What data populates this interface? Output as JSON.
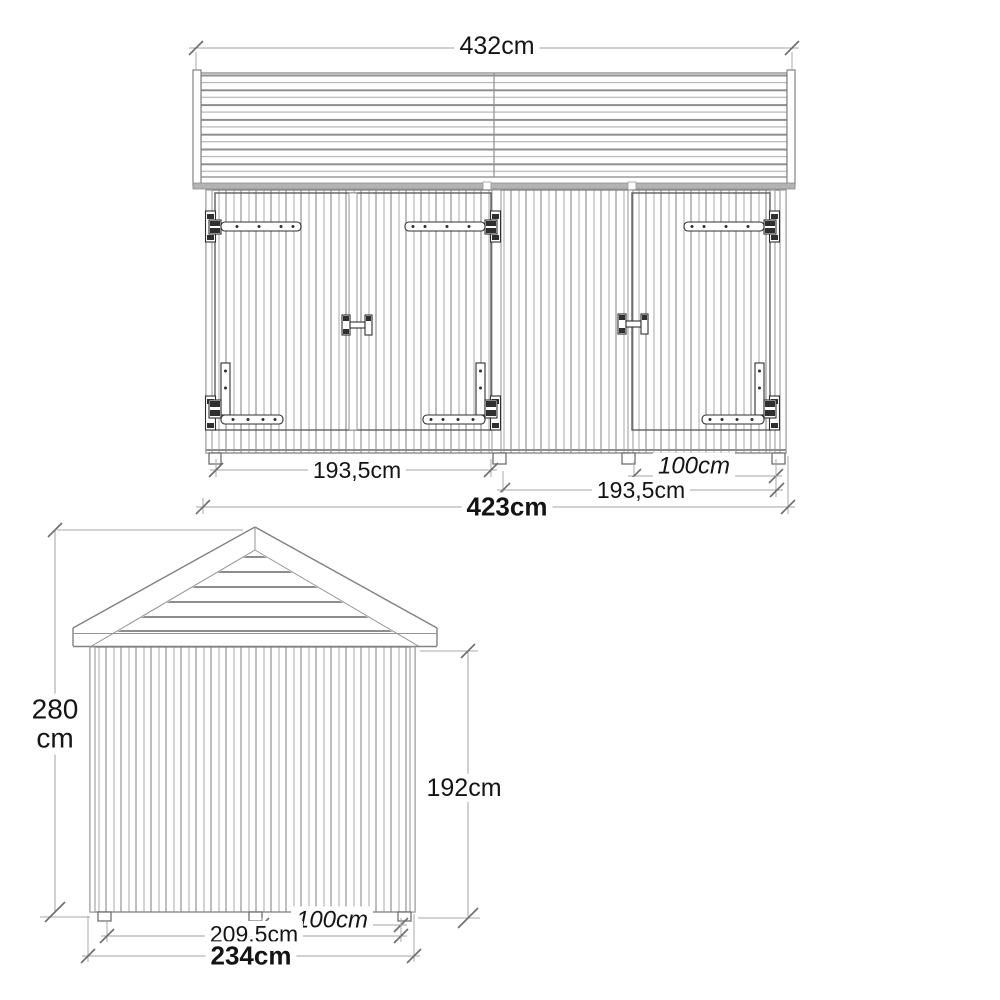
{
  "front_view": {
    "roof_width": "432cm",
    "double_door_width": "193,5cm",
    "single_door_width": "100cm",
    "right_module_width": "193,5cm",
    "total_width": "423cm"
  },
  "side_view": {
    "total_height_value": "280",
    "total_height_unit": "cm",
    "wall_height": "192cm",
    "base_span": "209,5cm",
    "base_right_span": "100cm",
    "total_depth": "234cm"
  },
  "colors": {
    "background": "#ffffff",
    "drawing_line": "#818181",
    "hardware_line": "#2f2f2f",
    "dimension_line": "#a3a3a3",
    "text": "#141414"
  }
}
